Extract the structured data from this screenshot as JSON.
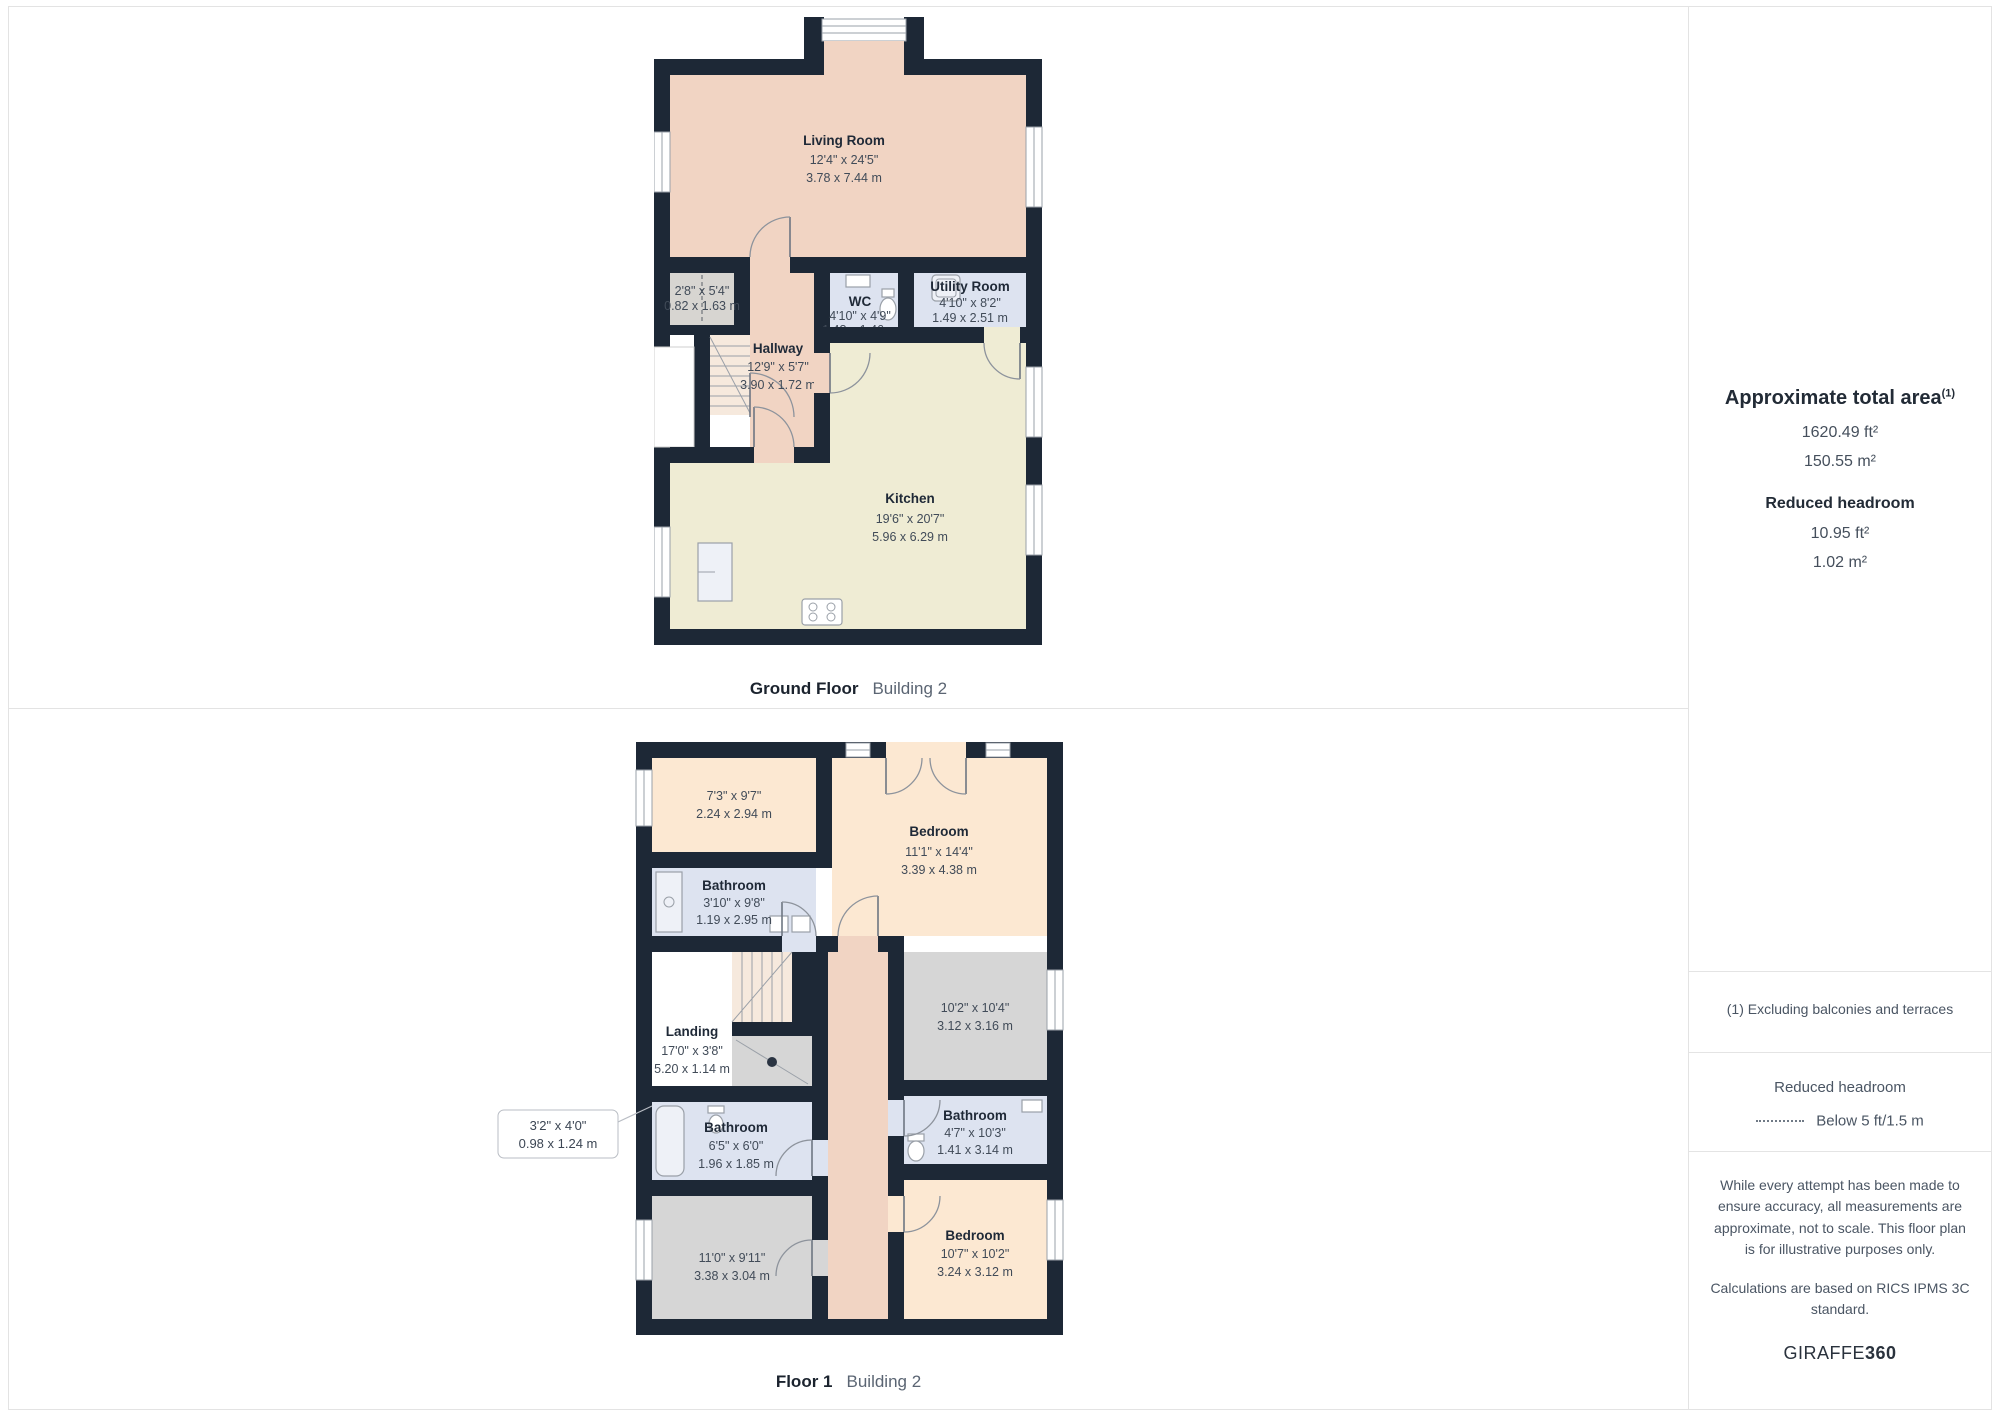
{
  "ground_floor": {
    "label": "Ground Floor",
    "building": "Building 2",
    "rooms": {
      "living": {
        "name": "Living Room",
        "ft": "12'4\" x 24'5\"",
        "m": "3.78 x 7.44 m"
      },
      "closet": {
        "ft": "2'8\" x 5'4\"",
        "m": "0.82 x 1.63 m"
      },
      "wc": {
        "name": "WC",
        "ft": "4'10\" x 4'9\"",
        "m": "1.48 x 1.46 m"
      },
      "utility": {
        "name": "Utility Room",
        "ft": "4'10\" x 8'2\"",
        "m": "1.49 x 2.51 m"
      },
      "hallway": {
        "name": "Hallway",
        "ft": "12'9\" x 5'7\"",
        "m": "3.90 x 1.72 m"
      },
      "kitchen": {
        "name": "Kitchen",
        "ft": "19'6\" x 20'7\"",
        "m": "5.96 x 6.29 m"
      }
    }
  },
  "floor1": {
    "label": "Floor 1",
    "building": "Building 2",
    "rooms": {
      "room_a": {
        "ft": "7'3\" x 9'7\"",
        "m": "2.24 x 2.94 m"
      },
      "bedroom1": {
        "name": "Bedroom",
        "ft": "11'1\" x 14'4\"",
        "m": "3.39 x 4.38 m"
      },
      "bathroom1": {
        "name": "Bathroom",
        "ft": "3'10\" x 9'8\"",
        "m": "1.19 x 2.95 m"
      },
      "landing": {
        "name": "Landing",
        "ft": "17'0\" x 3'8\"",
        "m": "5.20 x 1.14 m"
      },
      "room_b": {
        "ft": "10'2\" x 10'4\"",
        "m": "3.12 x 3.16 m"
      },
      "bathroom2": {
        "name": "Bathroom",
        "ft": "6'5\" x 6'0\"",
        "m": "1.96 x 1.85 m"
      },
      "callout": {
        "ft": "3'2\" x 4'0\"",
        "m": "0.98 x 1.24 m"
      },
      "bathroom3": {
        "name": "Bathroom",
        "ft": "4'7\" x 10'3\"",
        "m": "1.41 x 3.14 m"
      },
      "room_c": {
        "ft": "11'0\" x 9'11\"",
        "m": "3.38 x 3.04 m"
      },
      "bedroom2": {
        "name": "Bedroom",
        "ft": "10'7\" x 10'2\"",
        "m": "3.24 x 3.12 m"
      }
    }
  },
  "sidebar": {
    "total_area": {
      "title": "Approximate total area",
      "sup": "(1)",
      "ft": "1620.49 ft²",
      "m": "150.55 m²"
    },
    "reduced": {
      "title": "Reduced headroom",
      "ft": "10.95 ft²",
      "m": "1.02 m²"
    },
    "note": "(1) Excluding balconies and terraces",
    "legend": {
      "title": "Reduced headroom",
      "item": "Below 5 ft/1.5 m"
    },
    "disclaimer1": "While every attempt has been made to ensure accuracy, all measurements are approximate, not to scale. This floor plan is for illustrative purposes only.",
    "disclaimer2": "Calculations are based on RICS IPMS 3C standard.",
    "brand": {
      "name": "GIRAFFE",
      "suffix": "360"
    }
  },
  "colors": {
    "wall": "#1d2836",
    "warm": "#f1d4c3",
    "orange": "#fce8d2",
    "cream": "#efecd4",
    "bath": "#dde3f0",
    "gray": "#d6d6d6"
  }
}
